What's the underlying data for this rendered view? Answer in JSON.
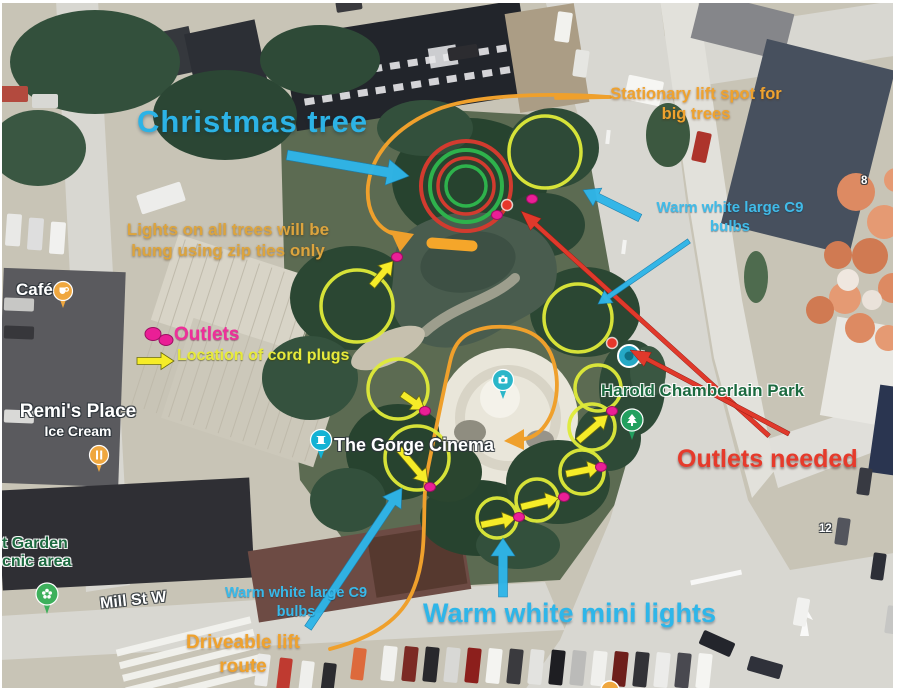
{
  "colors": {
    "cyan": "#2fb5e8",
    "orange": "#f0a12f",
    "yellow_text": "#e7ea3b",
    "ochre_text": "#dca43e",
    "pink": "#ea1f96",
    "red": "#e0392b",
    "circle_yellow": "#dfeb39",
    "arrow_yellow": "#f6ec28",
    "ring_red": "#d23b2f",
    "ring_green": "#2eb24c"
  },
  "map_labels": {
    "cafe": "Café",
    "remis_line1": "Remi's Place",
    "remis_line2": "Ice Cream",
    "cinema": "The Gorge Cinema",
    "park": "Harold Chamberlain Park",
    "garden_line1": "t Garden",
    "garden_line2": "cnic area",
    "street": "Mill St W",
    "route_8": "8",
    "route_12": "12"
  },
  "annotations": {
    "christmas_tree": "Christmas tree",
    "stationary": {
      "line1": "Stationary lift spot for",
      "line2": "big trees"
    },
    "zip": {
      "line1": "Lights on all trees will be",
      "line2": "hung using zip ties only"
    },
    "outlets_legend": "Outlets",
    "cord_plugs": "Location of cord plugs",
    "c9_right": {
      "line1": "Warm white large C9",
      "line2": "bulbs"
    },
    "outlets_needed": "Outlets needed",
    "c9_bottom": {
      "line1": "Warm white large C9",
      "line2": "bulbs"
    },
    "mini_lights": "Warm white mini lights",
    "driveable": {
      "line1": "Driveable lift",
      "line2": "route"
    }
  }
}
